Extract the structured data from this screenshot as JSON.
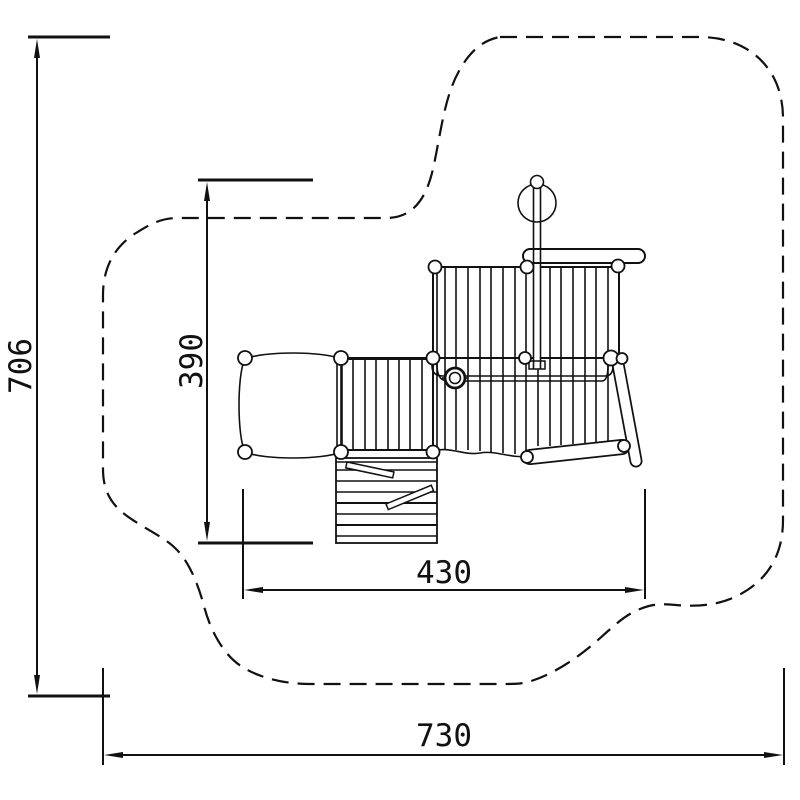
{
  "page": {
    "background_color": "#ffffff",
    "line_color": "#111111",
    "description": "Technical plan-view drawing of a playground climbing structure with dashed safety-zone outline and dimension lines"
  },
  "drawing": {
    "dimensions": [
      {
        "id": "overall-height",
        "label": "706",
        "orientation": "vertical",
        "side": "left"
      },
      {
        "id": "inner-height",
        "label": "390",
        "orientation": "vertical",
        "side": "left-inner"
      },
      {
        "id": "inner-width",
        "label": "430",
        "orientation": "horizontal",
        "side": "bottom-inner"
      },
      {
        "id": "overall-width",
        "label": "730",
        "orientation": "horizontal",
        "side": "bottom"
      }
    ],
    "parts": [
      {
        "name": "safety-zone-outline",
        "style": "dashed freeform blob"
      },
      {
        "name": "left-platform",
        "style": "pillow-shaped platform with four corner posts"
      },
      {
        "name": "lower-deck",
        "style": "slatted deck"
      },
      {
        "name": "upper-deck",
        "style": "large slatted deck"
      },
      {
        "name": "access-ramp",
        "style": "slatted ramp with two angled cleats"
      },
      {
        "name": "balance-beam",
        "style": "capsule beam with end posts"
      },
      {
        "name": "slide",
        "style": "diagonal capsule"
      },
      {
        "name": "handrail",
        "style": "double-line rail with elbows"
      },
      {
        "name": "firemans-pole",
        "style": "concentric circles on rail"
      },
      {
        "name": "telescope",
        "style": "circle on twin-line post with round cap"
      }
    ]
  }
}
